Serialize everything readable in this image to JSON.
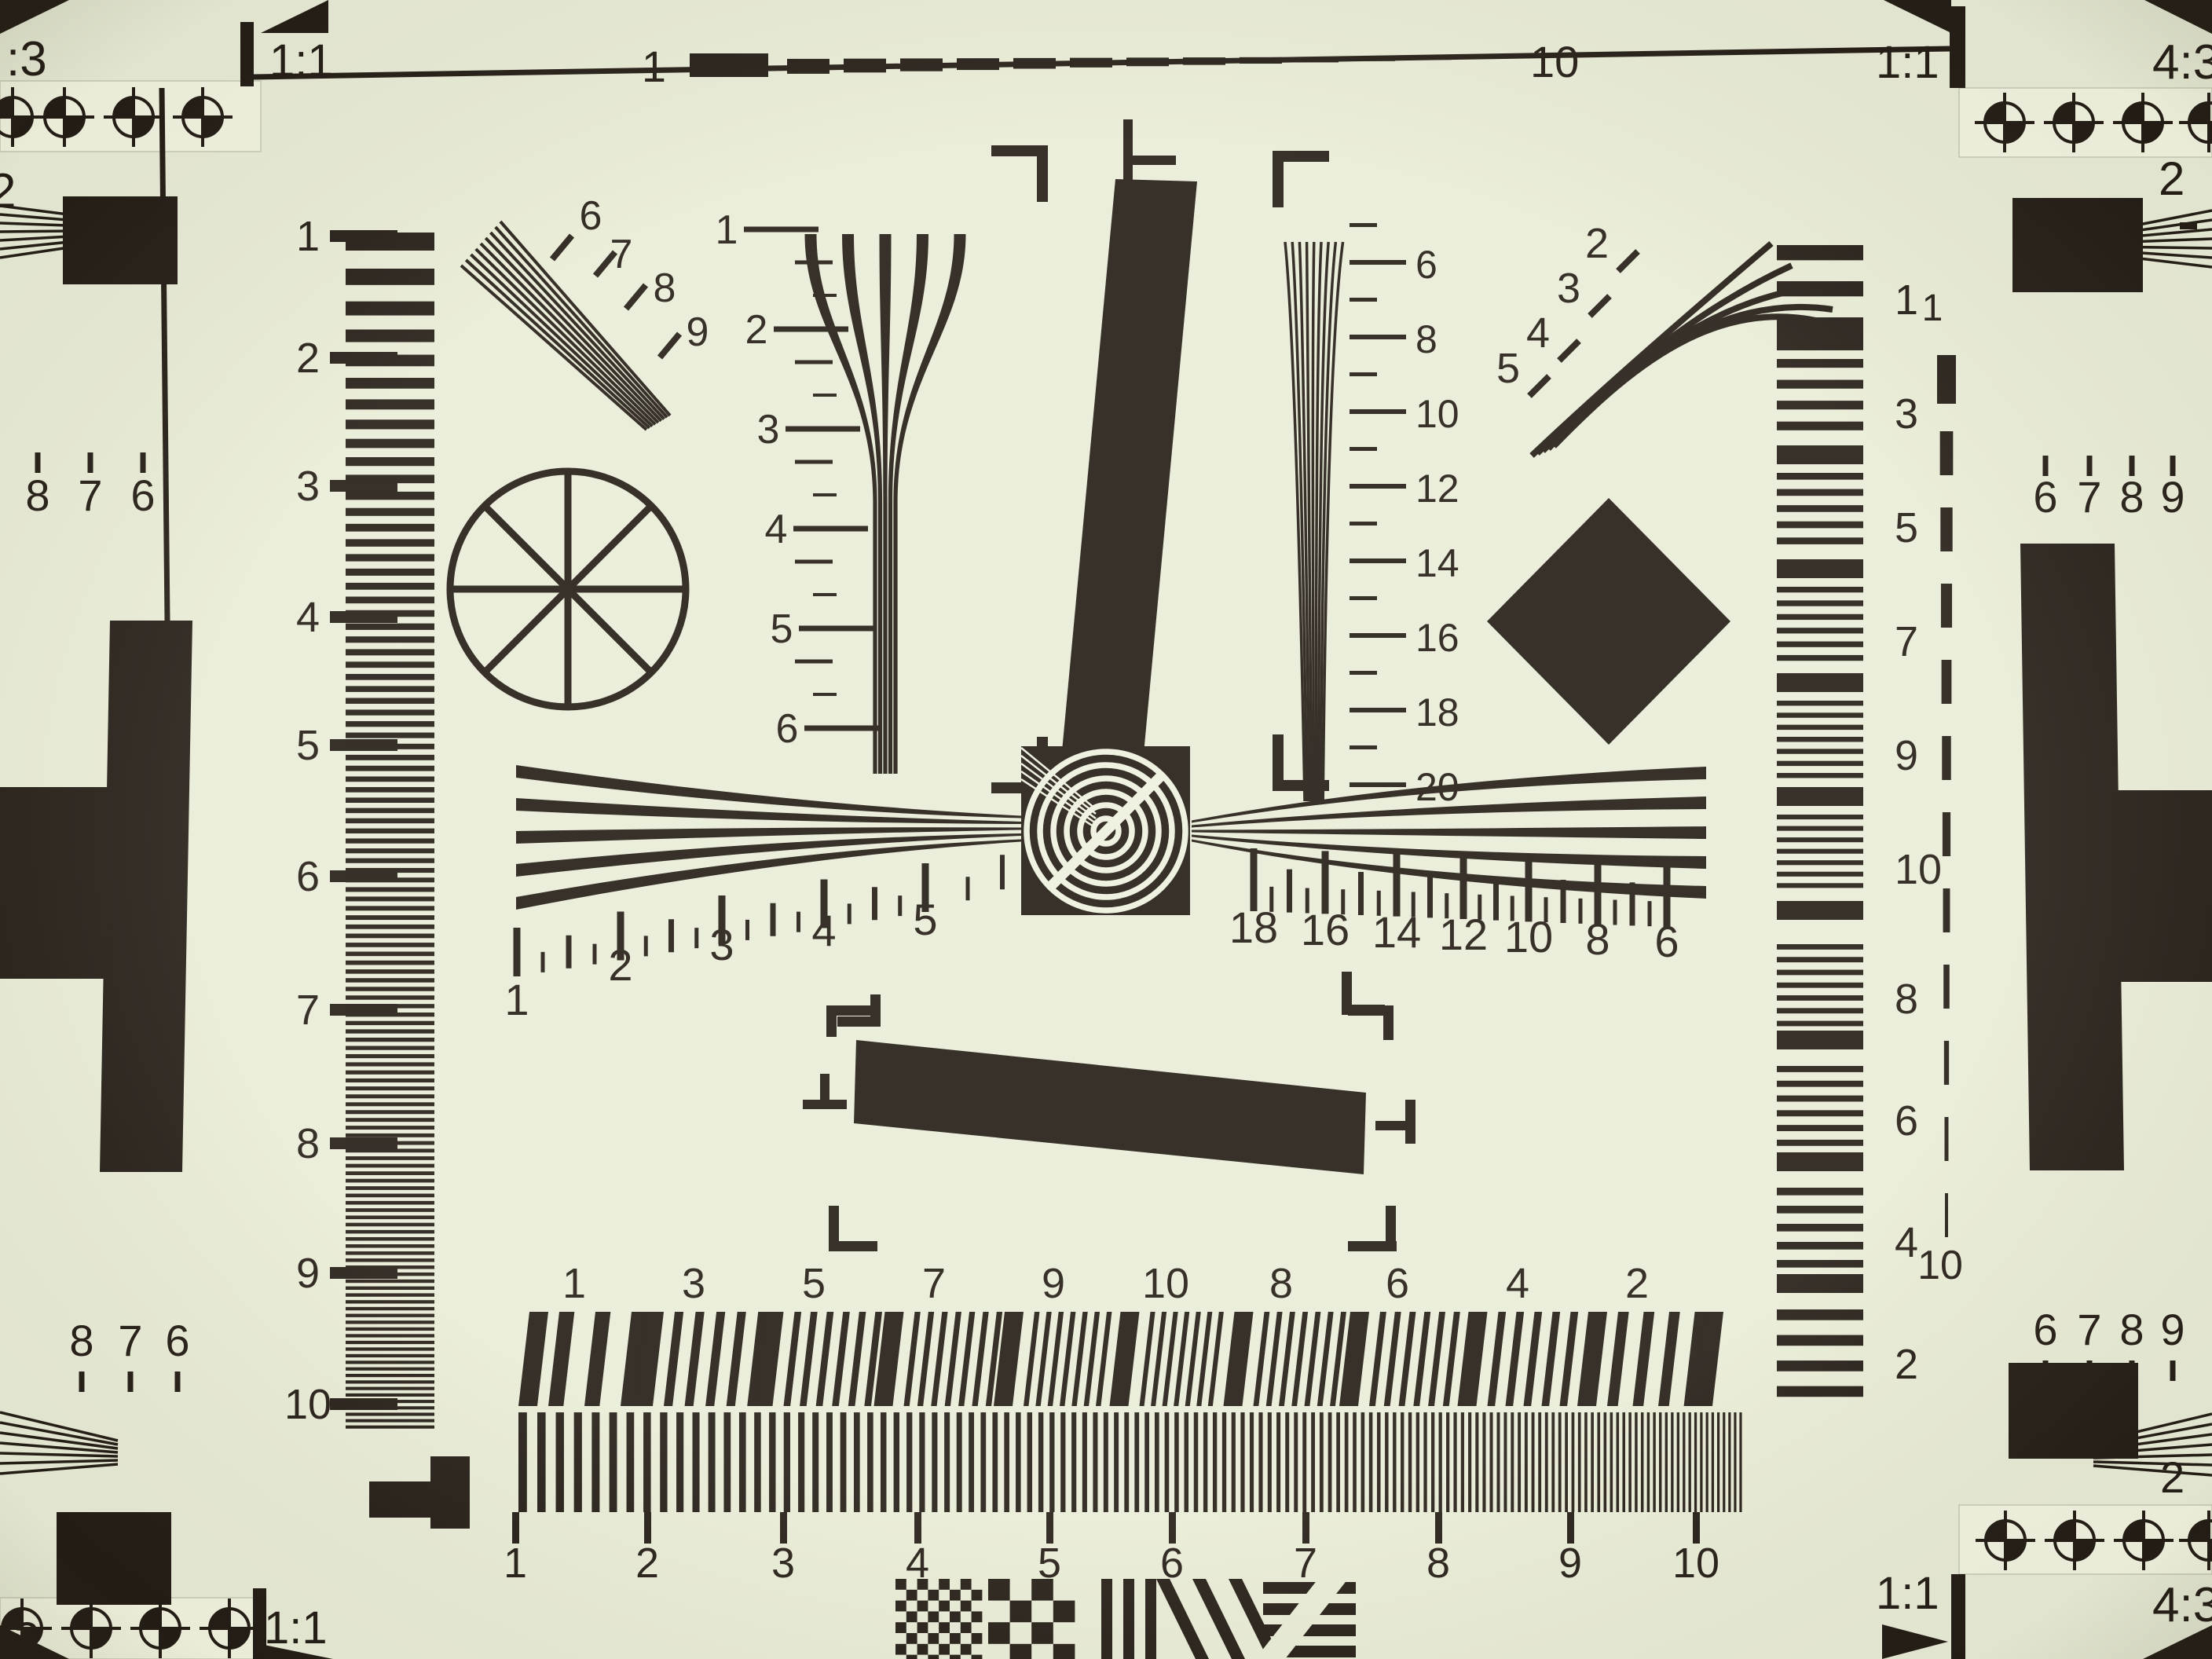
{
  "chart": {
    "colors": {
      "ink": "#211a14",
      "paper": "#e9ecd7",
      "strip": "#f3f5e2"
    },
    "corner_labels": {
      "top_left_outer": ":3",
      "top_left_inner": "1:1",
      "top_right_inner": "1:1",
      "top_right_outer": "4:3",
      "bottom_left_outer": ":3",
      "bottom_left_inner": "1:1",
      "bottom_right_inner": "1:1",
      "bottom_right_outer": "4:3"
    },
    "top_ruler": {
      "start": "1",
      "end": "10"
    },
    "left_scale": [
      "1",
      "2",
      "3",
      "4",
      "5",
      "6",
      "7",
      "8",
      "9",
      "10"
    ],
    "upper_left_fan_labels": [
      "6",
      "7",
      "8",
      "9"
    ],
    "center_wedge_scale": [
      "1",
      "2",
      "3",
      "4",
      "5",
      "6"
    ],
    "center_right_wedge_scale": [
      "6",
      "8",
      "10",
      "12",
      "14",
      "16",
      "18",
      "20"
    ],
    "upper_right_fan_labels": [
      "2",
      "3",
      "4",
      "5"
    ],
    "right_bar_scale": [
      "1",
      "3",
      "5",
      "7",
      "9",
      "10",
      "8",
      "6",
      "4",
      "2"
    ],
    "right_dashed_scale": {
      "start": "1",
      "end": "10"
    },
    "horizontal_left_scale": [
      "1",
      "2",
      "3",
      "4",
      "5"
    ],
    "horizontal_right_scale": [
      "18",
      "16",
      "14",
      "12",
      "10",
      "8",
      "6"
    ],
    "burst_top_scale": [
      "1",
      "3",
      "5",
      "7",
      "9",
      "10",
      "8",
      "6",
      "4",
      "2"
    ],
    "burst_bottom_scale": [
      "1",
      "2",
      "3",
      "4",
      "5",
      "6",
      "7",
      "8",
      "9",
      "10"
    ],
    "left_panel": {
      "top_digit": "2",
      "upper_group": [
        "8",
        "7",
        "6"
      ],
      "lower_group": [
        "8",
        "7",
        "6"
      ]
    },
    "right_panel": {
      "top_digit": "2",
      "bottom_digit": "2",
      "upper_group": [
        "6",
        "7",
        "8",
        "9"
      ],
      "lower_group": [
        "6",
        "7",
        "8",
        "9"
      ]
    }
  }
}
